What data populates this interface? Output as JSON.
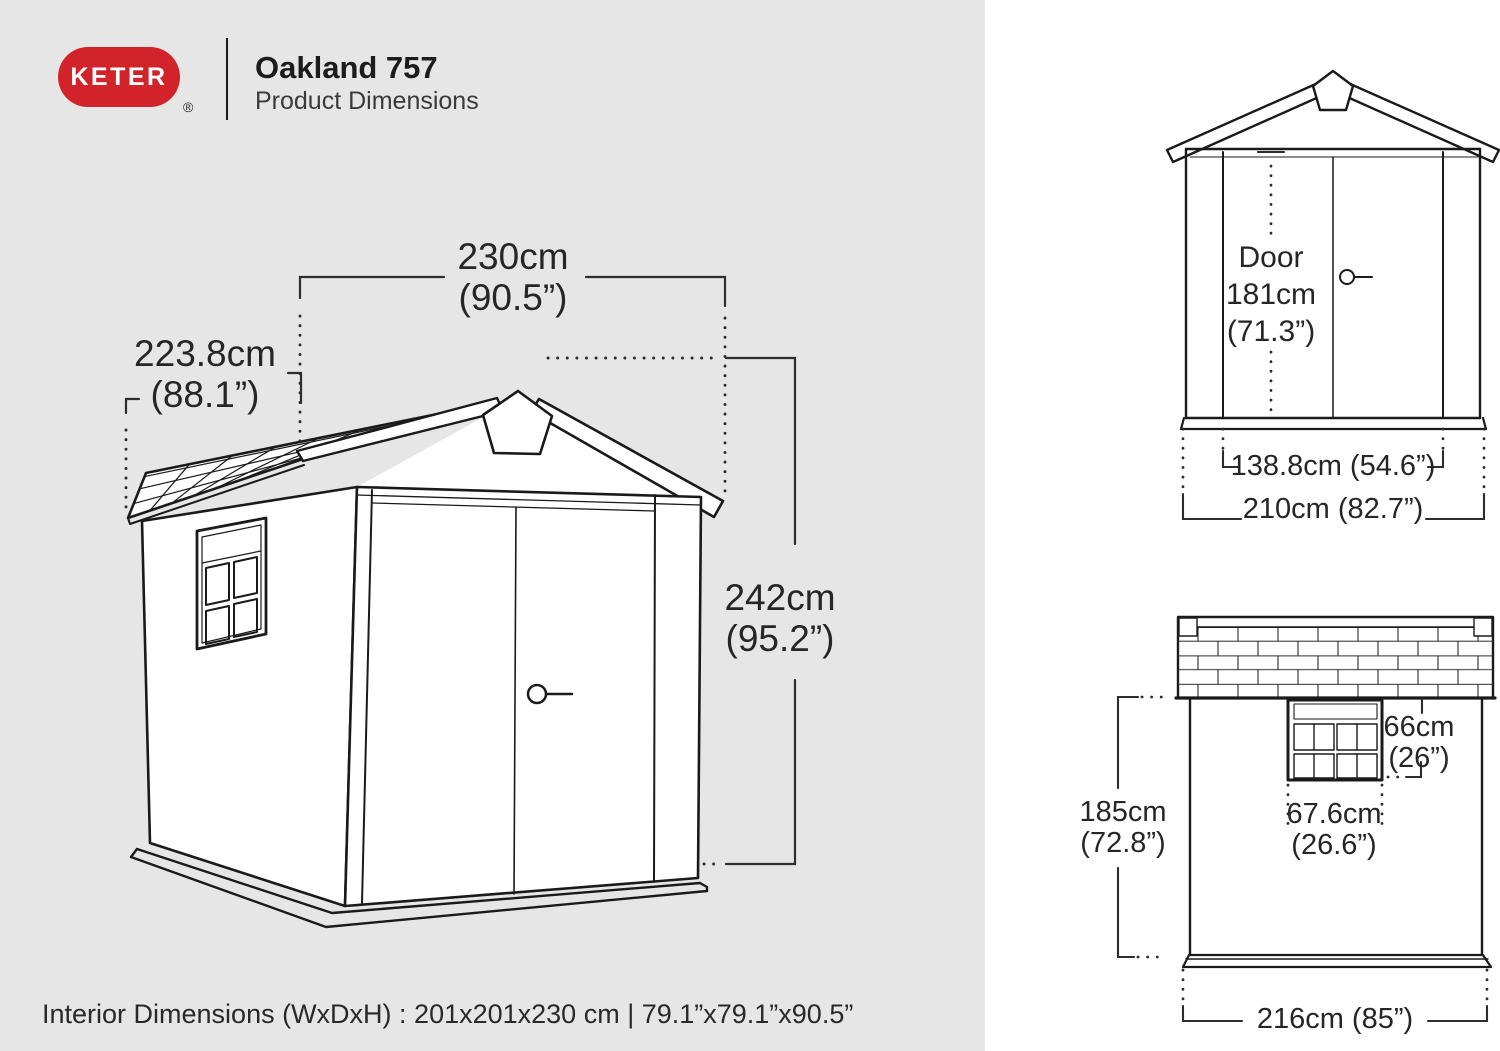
{
  "colors": {
    "brand_red": "#d2232a",
    "left_panel_bg": "#e6e6e6",
    "right_panel_bg": "#ffffff",
    "line_color": "#1a1a1a",
    "text_color": "#262626"
  },
  "header": {
    "brand": "KETER",
    "registered_mark": "®",
    "title": "Oakland 757",
    "subtitle": "Product Dimensions"
  },
  "main_view": {
    "width_cm": "230cm",
    "width_in": "(90.5”)",
    "depth_cm": "223.8cm",
    "depth_in": "(88.1”)",
    "height_cm": "242cm",
    "height_in": "(95.2”)"
  },
  "front_view": {
    "door_label": "Door",
    "door_height_cm": "181cm",
    "door_height_in": "(71.3”)",
    "door_width": "138.8cm (54.6”)",
    "overall_width": "210cm (82.7”)"
  },
  "side_view": {
    "window_height_cm": "66cm",
    "window_height_in": "(26”)",
    "height_cm": "185cm",
    "height_in": "(72.8”)",
    "window_width_cm": "67.6cm",
    "window_width_in": "(26.6”)",
    "overall_width": "216cm (85”)"
  },
  "footer": {
    "interior_dimensions": "Interior Dimensions (WxDxH) : 201x201x230 cm | 79.1”x79.1”x90.5”"
  }
}
